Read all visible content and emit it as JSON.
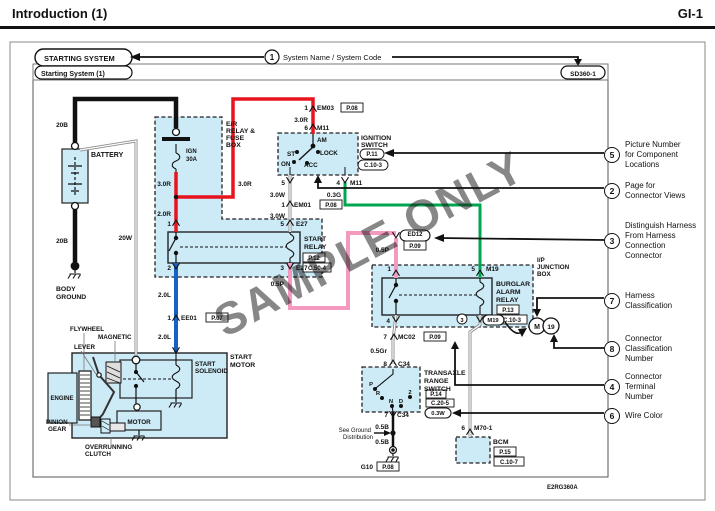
{
  "header": {
    "title": "Introduction (1)",
    "page_code": "GI-1"
  },
  "watermark": "SAMPLE ONLY",
  "colors": {
    "wire_red": "#e8131d",
    "wire_blue": "#1760c4",
    "wire_green": "#00a550",
    "wire_pink": "#f49ac1",
    "wire_gray": "#8c8c8c",
    "wire_black": "#111111",
    "component_fill": "#cdeaf7"
  },
  "callouts": [
    {
      "num": "5",
      "top": 140,
      "lines": [
        "Picture Number",
        "for Component",
        "Locations"
      ]
    },
    {
      "num": "2",
      "top": 181,
      "lines": [
        "Page for",
        "Connector Views"
      ]
    },
    {
      "num": "3",
      "top": 221,
      "lines": [
        "Distinguish Harness",
        "From Harness",
        "Connection",
        "Connector"
      ]
    },
    {
      "num": "7",
      "top": 291,
      "lines": [
        "Harness",
        "Classification"
      ]
    },
    {
      "num": "8",
      "top": 334,
      "lines": [
        "Connector",
        "Classification",
        "Number"
      ]
    },
    {
      "num": "4",
      "top": 372,
      "lines": [
        "Connector",
        "Terminal",
        "Number"
      ]
    },
    {
      "num": "6",
      "top": 408,
      "lines": [
        "Wire Color"
      ]
    }
  ],
  "diagram": {
    "labels": [
      {
        "x": 44,
        "y": 61,
        "t": "STARTING SYSTEM",
        "s": 7.5
      },
      {
        "x": 41,
        "y": 76,
        "t": "Starting System (1)",
        "s": 7
      },
      {
        "x": 583,
        "y": 76,
        "t": "SD360-1",
        "a": "m",
        "s": 6.5
      },
      {
        "x": 272,
        "y": 60,
        "t": "1",
        "a": "m",
        "s": 8
      },
      {
        "x": 283,
        "y": 60,
        "t": "System Name / System Code",
        "s": 7.5,
        "w": "n"
      },
      {
        "x": 68,
        "y": 127,
        "t": "20B",
        "a": "e"
      },
      {
        "x": 91,
        "y": 157,
        "t": "BATTERY",
        "s": 7
      },
      {
        "x": 68,
        "y": 243,
        "t": "20B",
        "a": "e"
      },
      {
        "x": 132,
        "y": 240,
        "t": "20W",
        "a": "e"
      },
      {
        "x": 56,
        "y": 291,
        "t": "BODY",
        "s": 6.8
      },
      {
        "x": 56,
        "y": 299,
        "t": "GROUND",
        "s": 6.8
      },
      {
        "x": 226,
        "y": 126,
        "t": "E/R",
        "s": 6.8
      },
      {
        "x": 226,
        "y": 133,
        "t": "RELAY &",
        "s": 6.8
      },
      {
        "x": 226,
        "y": 140,
        "t": "FUSE",
        "s": 6.8
      },
      {
        "x": 226,
        "y": 147,
        "t": "BOX",
        "s": 6.8
      },
      {
        "x": 186,
        "y": 153,
        "t": "IGN",
        "s": 6
      },
      {
        "x": 186,
        "y": 161,
        "t": "30A",
        "s": 6
      },
      {
        "x": 171,
        "y": 186,
        "t": "3.0R",
        "a": "e"
      },
      {
        "x": 238,
        "y": 186,
        "t": "3.0R"
      },
      {
        "x": 171,
        "y": 216,
        "t": "2.0R",
        "a": "e"
      },
      {
        "x": 171,
        "y": 226,
        "t": "1",
        "a": "e"
      },
      {
        "x": 284,
        "y": 226,
        "t": "5",
        "a": "e"
      },
      {
        "x": 296,
        "y": 226,
        "t": "E27"
      },
      {
        "x": 304,
        "y": 241,
        "t": "START",
        "s": 6.8
      },
      {
        "x": 304,
        "y": 249,
        "t": "RELAY",
        "s": 6.8
      },
      {
        "x": 314,
        "y": 260,
        "t": "P.12",
        "a": "m",
        "s": 6
      },
      {
        "x": 317,
        "y": 270,
        "t": "C.50-4",
        "a": "m",
        "s": 6
      },
      {
        "x": 171,
        "y": 270,
        "t": "2",
        "a": "e"
      },
      {
        "x": 284,
        "y": 270,
        "t": "3",
        "a": "e"
      },
      {
        "x": 296,
        "y": 270,
        "t": "E27"
      },
      {
        "x": 284,
        "y": 286,
        "t": "0.5P",
        "a": "e"
      },
      {
        "x": 171,
        "y": 297,
        "t": "2.0L",
        "a": "e"
      },
      {
        "x": 171,
        "y": 320,
        "t": "1",
        "a": "e"
      },
      {
        "x": 181,
        "y": 320,
        "t": "EE01"
      },
      {
        "x": 217,
        "y": 320,
        "t": "P.07",
        "a": "m",
        "s": 6
      },
      {
        "x": 171,
        "y": 339,
        "t": "2.0L",
        "a": "e"
      },
      {
        "x": 230,
        "y": 359,
        "t": "START",
        "s": 6.8
      },
      {
        "x": 230,
        "y": 367,
        "t": "MOTOR",
        "s": 6.8
      },
      {
        "x": 195,
        "y": 366,
        "t": "START",
        "s": 6.3
      },
      {
        "x": 195,
        "y": 373,
        "t": "SOLENOID",
        "s": 6.3
      },
      {
        "x": 139,
        "y": 424,
        "t": "MOTOR",
        "a": "m",
        "s": 6.3
      },
      {
        "x": 70,
        "y": 331,
        "t": "FLYWHEEL",
        "s": 6.3
      },
      {
        "x": 98,
        "y": 339,
        "t": "MAGNETIC",
        "s": 6.3
      },
      {
        "x": 74,
        "y": 349,
        "t": "LEVER",
        "s": 6.3
      },
      {
        "x": 46,
        "y": 424,
        "t": "PINION",
        "s": 6.3
      },
      {
        "x": 48,
        "y": 431,
        "t": "GEAR",
        "s": 6.3
      },
      {
        "x": 85,
        "y": 449,
        "t": "OVERRUNNING",
        "s": 6.3
      },
      {
        "x": 85,
        "y": 456,
        "t": "CLUTCH",
        "s": 6.3
      },
      {
        "x": 62,
        "y": 400,
        "t": "ENGINE",
        "a": "m",
        "s": 6
      },
      {
        "x": 308,
        "y": 110,
        "t": "1",
        "a": "e"
      },
      {
        "x": 317,
        "y": 110,
        "t": "EM03"
      },
      {
        "x": 352,
        "y": 110,
        "t": "P.08",
        "a": "m",
        "s": 6
      },
      {
        "x": 308,
        "y": 122,
        "t": "3.0R",
        "a": "e"
      },
      {
        "x": 308,
        "y": 130,
        "t": "6",
        "a": "e"
      },
      {
        "x": 317,
        "y": 130,
        "t": "M11"
      },
      {
        "x": 317,
        "y": 142,
        "t": "AM",
        "s": 6.3
      },
      {
        "x": 287,
        "y": 156,
        "t": "ST",
        "s": 6.3
      },
      {
        "x": 320,
        "y": 155,
        "t": "LOCK",
        "s": 6.3
      },
      {
        "x": 281,
        "y": 166,
        "t": "ON",
        "s": 6.3
      },
      {
        "x": 304,
        "y": 167,
        "t": "ACC",
        "s": 6.3
      },
      {
        "x": 361,
        "y": 140,
        "t": "IGNITION",
        "s": 6.8
      },
      {
        "x": 361,
        "y": 147,
        "t": "SWITCH",
        "s": 6.8
      },
      {
        "x": 372,
        "y": 156,
        "t": "P.11",
        "a": "m",
        "s": 6
      },
      {
        "x": 373,
        "y": 167,
        "t": "C.10-3",
        "a": "m",
        "s": 6
      },
      {
        "x": 285,
        "y": 185,
        "t": "5",
        "a": "e"
      },
      {
        "x": 340,
        "y": 185,
        "t": "4",
        "a": "e"
      },
      {
        "x": 350,
        "y": 185,
        "t": "M11"
      },
      {
        "x": 285,
        "y": 197,
        "t": "3.0W",
        "a": "e"
      },
      {
        "x": 341,
        "y": 197,
        "t": "0.3G",
        "a": "e"
      },
      {
        "x": 285,
        "y": 207,
        "t": "1",
        "a": "e"
      },
      {
        "x": 294,
        "y": 207,
        "t": "EM01"
      },
      {
        "x": 331,
        "y": 207,
        "t": "P.08",
        "a": "m",
        "s": 6
      },
      {
        "x": 285,
        "y": 218,
        "t": "3.0W",
        "a": "e"
      },
      {
        "x": 389,
        "y": 252,
        "t": "0.5P",
        "a": "e"
      },
      {
        "x": 415,
        "y": 236,
        "t": "ED12",
        "a": "m",
        "s": 6
      },
      {
        "x": 415,
        "y": 248,
        "t": "P.09",
        "a": "m",
        "s": 6
      },
      {
        "x": 391,
        "y": 271,
        "t": "1",
        "a": "e"
      },
      {
        "x": 475,
        "y": 271,
        "t": "5",
        "a": "e"
      },
      {
        "x": 486,
        "y": 271,
        "t": "M19"
      },
      {
        "x": 496,
        "y": 286,
        "t": "BURGLAR",
        "s": 6.8
      },
      {
        "x": 496,
        "y": 294,
        "t": "ALARM",
        "s": 6.8
      },
      {
        "x": 496,
        "y": 302,
        "t": "RELAY",
        "s": 6.8
      },
      {
        "x": 508,
        "y": 312,
        "t": "P.13",
        "a": "m",
        "s": 6
      },
      {
        "x": 512,
        "y": 322,
        "t": "C.10-3",
        "a": "m",
        "s": 6
      },
      {
        "x": 537,
        "y": 262,
        "t": "I/P",
        "s": 6.3
      },
      {
        "x": 537,
        "y": 269,
        "t": "JUNCTION",
        "s": 6.3
      },
      {
        "x": 537,
        "y": 276,
        "t": "BOX",
        "s": 6.3
      },
      {
        "x": 390,
        "y": 323,
        "t": "4",
        "a": "e"
      },
      {
        "x": 462,
        "y": 322,
        "t": "3",
        "a": "m",
        "s": 5.8
      },
      {
        "x": 493,
        "y": 322,
        "t": "M19",
        "a": "m",
        "s": 5.8
      },
      {
        "x": 387,
        "y": 339,
        "t": "7",
        "a": "e"
      },
      {
        "x": 398,
        "y": 339,
        "t": "MC02"
      },
      {
        "x": 435,
        "y": 339,
        "t": "P.09",
        "a": "m",
        "s": 6
      },
      {
        "x": 387,
        "y": 353,
        "t": "0.5Gr",
        "a": "e"
      },
      {
        "x": 387,
        "y": 366,
        "t": "8",
        "a": "e"
      },
      {
        "x": 398,
        "y": 366,
        "t": "C34"
      },
      {
        "x": 424,
        "y": 375,
        "t": "TRANSAXLE",
        "s": 6.8
      },
      {
        "x": 424,
        "y": 383,
        "t": "RANGE",
        "s": 6.8
      },
      {
        "x": 424,
        "y": 391,
        "t": "SWITCH",
        "s": 6.8
      },
      {
        "x": 436,
        "y": 396,
        "t": "P.14",
        "a": "m",
        "s": 6
      },
      {
        "x": 440,
        "y": 405,
        "t": "C.20-5",
        "a": "m",
        "s": 6
      },
      {
        "x": 371,
        "y": 386,
        "t": "P",
        "a": "m",
        "s": 5.8
      },
      {
        "x": 378,
        "y": 395,
        "t": "R",
        "a": "m",
        "s": 5.8
      },
      {
        "x": 391,
        "y": 403,
        "t": "N",
        "a": "m",
        "s": 5.8
      },
      {
        "x": 401,
        "y": 403,
        "t": "D",
        "a": "m",
        "s": 5.8
      },
      {
        "x": 410,
        "y": 394,
        "t": "2",
        "a": "m",
        "s": 5.8
      },
      {
        "x": 388,
        "y": 417,
        "t": "7",
        "a": "e"
      },
      {
        "x": 397,
        "y": 417,
        "t": "C34"
      },
      {
        "x": 389,
        "y": 429,
        "t": "0.5B",
        "a": "e"
      },
      {
        "x": 371,
        "y": 432,
        "t": "See Ground",
        "a": "e",
        "s": 6,
        "w": "n"
      },
      {
        "x": 373,
        "y": 439,
        "t": "Distribution",
        "a": "e",
        "s": 6,
        "w": "n"
      },
      {
        "x": 389,
        "y": 444,
        "t": "0.5B",
        "a": "e"
      },
      {
        "x": 373,
        "y": 469,
        "t": "G10",
        "a": "e"
      },
      {
        "x": 388,
        "y": 469,
        "t": "P.08",
        "a": "m",
        "s": 6
      },
      {
        "x": 438,
        "y": 415,
        "t": "0.3W",
        "a": "m",
        "s": 5.8
      },
      {
        "x": 465,
        "y": 430,
        "t": "6",
        "a": "e"
      },
      {
        "x": 474,
        "y": 430,
        "t": "M70-1"
      },
      {
        "x": 493,
        "y": 444,
        "t": "BCM",
        "s": 6.8
      },
      {
        "x": 505,
        "y": 454,
        "t": "P.15",
        "a": "m",
        "s": 6
      },
      {
        "x": 509,
        "y": 464,
        "t": "C.10-7",
        "a": "m",
        "s": 6
      },
      {
        "x": 537,
        "y": 329,
        "t": "M",
        "a": "m",
        "s": 7
      },
      {
        "x": 551,
        "y": 329,
        "t": "19",
        "a": "m",
        "s": 6.5
      },
      {
        "x": 547,
        "y": 489,
        "t": "E2RG360A",
        "s": 6
      }
    ]
  }
}
